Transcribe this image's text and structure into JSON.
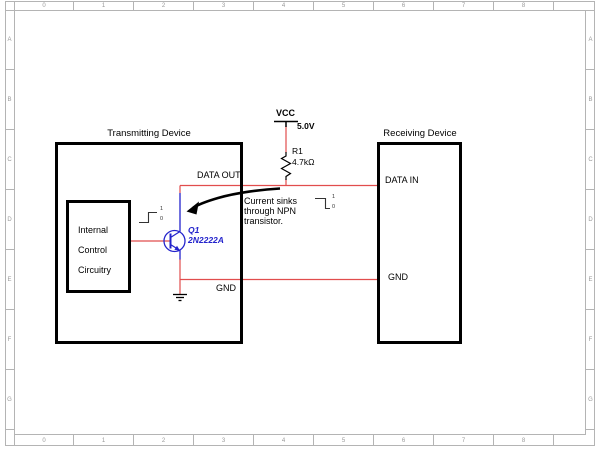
{
  "sheet": {
    "column_labels": [
      "0",
      "1",
      "2",
      "3",
      "4",
      "5",
      "6",
      "7",
      "8"
    ],
    "row_labels": [
      "A",
      "B",
      "C",
      "D",
      "E",
      "F",
      "G"
    ]
  },
  "transmitter": {
    "title": "Transmitting Device",
    "internal_block": {
      "line1": "Internal",
      "line2": "Control",
      "line3": "Circuitry"
    },
    "pin_labels": {
      "data_out": "DATA OUT",
      "gnd": "GND"
    }
  },
  "receiver": {
    "title": "Receiving Device",
    "pin_labels": {
      "data_in": "DATA IN",
      "gnd": "GND"
    }
  },
  "power_rail": {
    "net": "VCC",
    "voltage": "5.0V"
  },
  "resistor": {
    "ref": "R1",
    "value": "4.7kΩ"
  },
  "transistor": {
    "ref": "Q1",
    "part": "2N2222A"
  },
  "annotation": {
    "line1": "Current sinks",
    "line2": "through NPN",
    "line3": "transistor."
  },
  "waveforms": {
    "tx_input": {
      "high": "1",
      "low": "0",
      "edge": "rising"
    },
    "rx_input": {
      "high": "1",
      "low": "0",
      "edge": "falling"
    }
  },
  "colors": {
    "wire": "#e14d4d",
    "component": "#2424cc",
    "outline": "#000000",
    "frame_line": "#b4b4b4",
    "frame_text": "#9a9a9a"
  }
}
